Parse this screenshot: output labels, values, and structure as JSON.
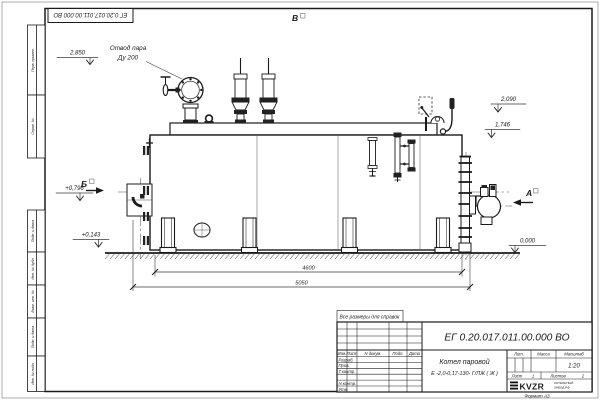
{
  "sheet": {
    "doc_number_top": "ЕГ 0.20.017.011.00.000  ВО",
    "reference_note": "Все размеры для справок",
    "format_label": "Формат А3"
  },
  "margin_labels": [
    "Перв. примен.",
    "Справ. №",
    "Подп. и дата",
    "Инв. № дубл.",
    "Взам. инв. №",
    "Подп. и дата",
    "Инв. № подл."
  ],
  "annotations": {
    "steam_note1": "Отвод пара",
    "steam_note2": "Ду 200",
    "lvl_2850": "2,850",
    "lvl_2090": "2,090",
    "lvl_1746": "1,746",
    "lvl_0796": "+0,796",
    "lvl_0143": "+0,143",
    "lvl_0000": "0,000",
    "view_a": "А",
    "view_b": "Б",
    "view_v": "В"
  },
  "dimensions": {
    "furnace_length": "4600",
    "overall_length": "5050"
  },
  "title_block": {
    "doc_number": "ЕГ 0.20.017.011.00.000  ВО",
    "name_line1": "Котел паровой",
    "name_line2": "Е -2,0-0,17-130- Г/ЛЖ ( Ж )",
    "col_izm": "Изм.",
    "col_list": "Лист",
    "col_ndoc": "N докум.",
    "col_podp": "Подп.",
    "col_data": "Дата",
    "row_razrab": "Разраб.",
    "row_prov": "Пров.",
    "row_tkontr": "Т.контр.",
    "row_nkontr": "Н.контр.",
    "row_utv": "Утв.",
    "h_lit": "Лит.",
    "h_massa": "Масса",
    "h_masshtab": "Масштаб",
    "scale_value": "1:20",
    "list_label": "Лист",
    "list_value": "1",
    "listov_label": "Листов",
    "listov_value": "2",
    "logo_text": "KVZR",
    "logo_sub1": "КОТЕЛЬНЫЙ",
    "logo_sub2": "ЗАВОД РФ"
  }
}
